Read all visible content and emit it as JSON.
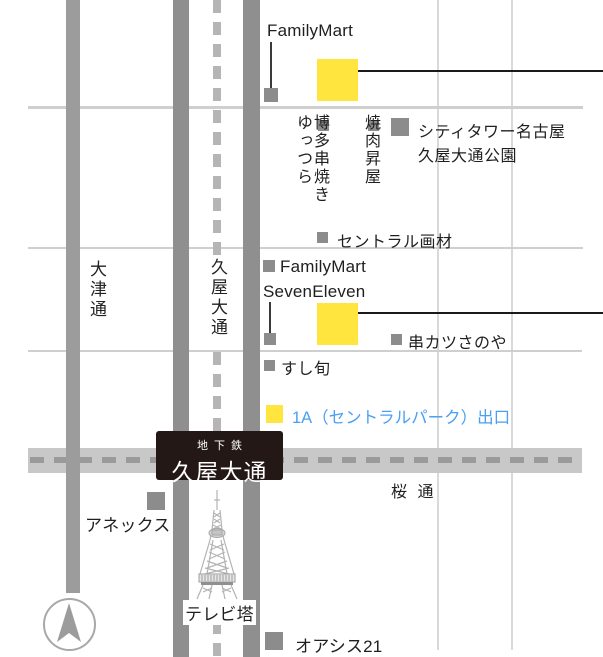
{
  "map": {
    "title": "Hisaya-odori station area access map",
    "streets": {
      "otsu_dori": "大津通",
      "hisaya_odori": "久屋大通",
      "sakura_dori": "桜 通"
    },
    "station": {
      "line": "地下鉄",
      "name": "久屋大通"
    },
    "legend": {
      "exit": "1A（セントラルパーク）出口"
    },
    "pois": {
      "familymart_north": {
        "label": "FamilyMart"
      },
      "city_tower": {
        "label": "シティタワー名古屋"
      },
      "hisaya_park": {
        "label": "久屋大通公園"
      },
      "hakata_kushiyaki": {
        "line1": "博多串焼き",
        "line2": "ゆっつら"
      },
      "yakiniku_shoya": {
        "label": "焼肉昇屋"
      },
      "central_gazai": {
        "label": "セントラル画材"
      },
      "familymart_south": {
        "label": "FamilyMart"
      },
      "seven_eleven": {
        "label": "SevenEleven"
      },
      "kushikatsu_sanoya": {
        "label": "串カツさのや"
      },
      "sushi_shun": {
        "label": "すし旬"
      },
      "annex": {
        "label": "アネックス"
      },
      "tv_tower": {
        "label": "テレビ塔"
      },
      "oasis21": {
        "label": "オアシス21"
      }
    },
    "colors": {
      "highlight_yellow": "#ffe53e",
      "exit_text_blue": "#4aa0f2",
      "main_road_gray": "#8f8f8f",
      "minor_road_gray": "#cfcfcf",
      "sakura_road_gray": "#c8c8c8",
      "subway_dash_gray": "#b5b5b5",
      "station_box_black": "#231815",
      "marker_gray": "#8c8c8c"
    }
  }
}
